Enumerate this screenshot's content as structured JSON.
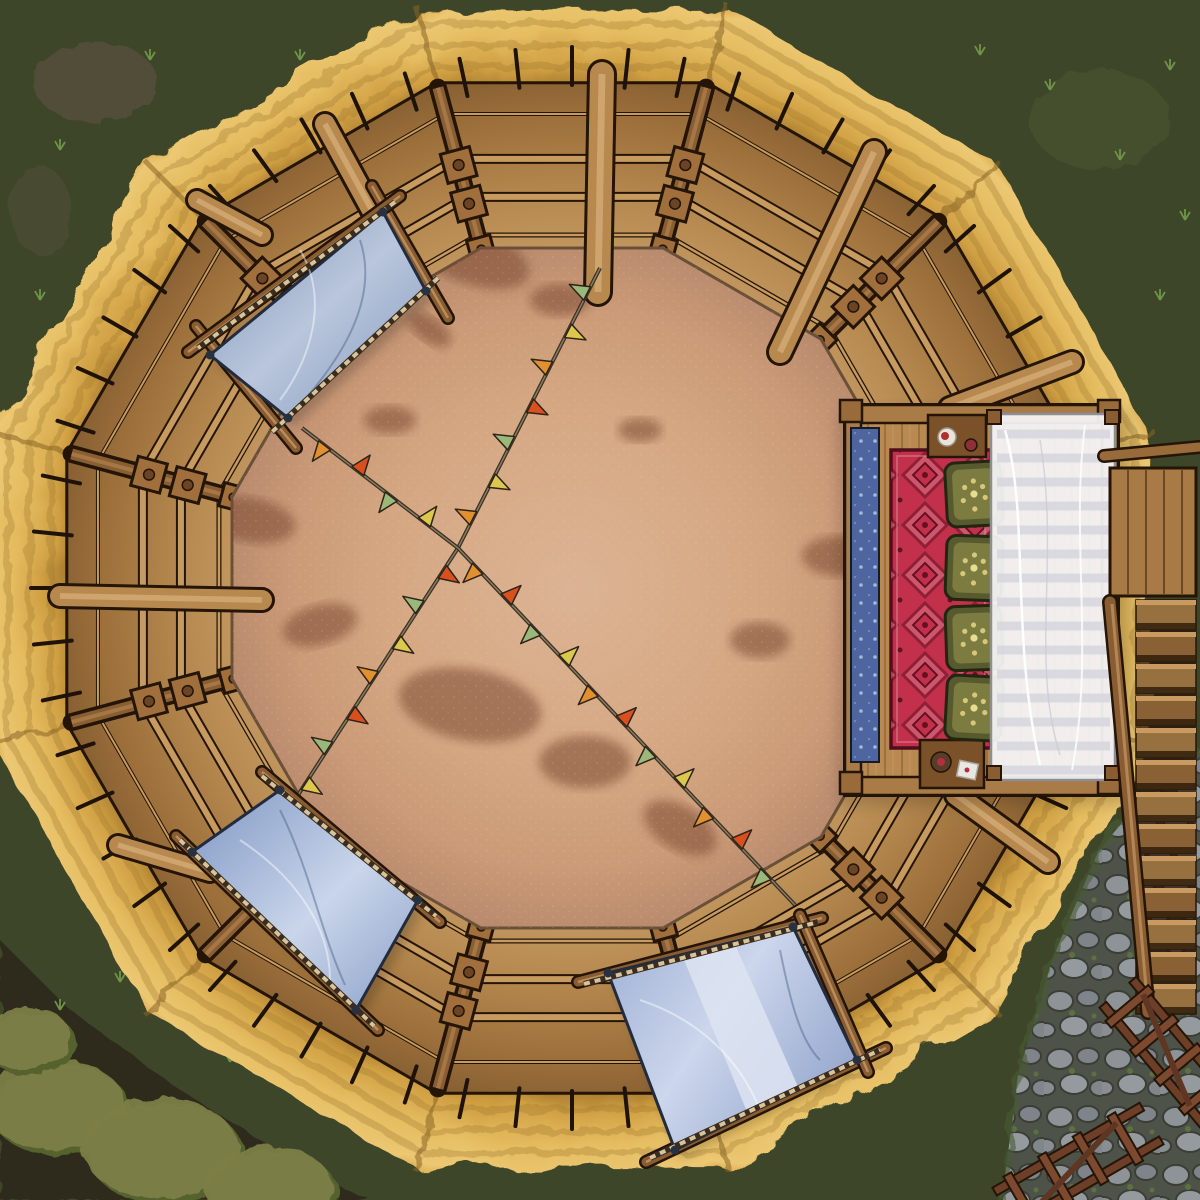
{
  "title": "Top-down circular arena battle map with thatched roof ring, palisade wall, VIP platform and canvas awnings",
  "palette": {
    "grass_dark": "#3d4629",
    "grass_plant": "#6f9448",
    "soil_dark": "#2f2a1e",
    "bush_olive": "#7d7f47",
    "bush_shadow": "#55622f",
    "dirt_patch": "#5c5140",
    "cobble_bg": "#4e5349",
    "cobble_stone": "#8d9397",
    "moss_green": "#5d7040",
    "thatch_base": "#c89a45",
    "thatch_gold": "#ddab52",
    "thatch_light": "#ecc873",
    "thatch_shadow": "#9c742f",
    "seam_brown": "#8a6528",
    "wood_light": "#c79a5f",
    "wood_mid": "#a87b46",
    "wood_beam": "#b8894f",
    "wood_dark": "#6b4423",
    "outline": "#241507",
    "floor_sand": "#d3a27f",
    "floor_sand_light": "#dcb394",
    "floor_patch": "#7c4a33",
    "canvas_blue": "#8398bc",
    "canvas_blue_light": "#c9d5ea",
    "canvas_pale": "#dde4f2",
    "canopy_white": "#f4f4f6",
    "canopy_stripe": "#d5d5dc",
    "carpet_red": "#c2304b",
    "carpet_pink": "#d8778a",
    "carpet_maroon": "#5e1020",
    "runner_blue": "#4e66a0",
    "cushion_olive": "#565a2e",
    "cushion_inner": "#7c7c41",
    "cushion_gold": "#d6c878",
    "rope_tan": "#d7c49a",
    "rope_dark": "#3a2d1f",
    "flag_green": "#9bb87b",
    "flag_yellow": "#ddc84e",
    "flag_orange": "#e2902f",
    "flag_red": "#d9501f"
  },
  "objects": {
    "arena": "circular dirt fighting pit inside a 12-sided palisade",
    "roof": "golden thatch ring with 12 radial seams",
    "awnings": 3,
    "awning_color": "steel blue canvas",
    "bunting_lines": 2,
    "flag_colors": [
      "green",
      "yellow",
      "orange",
      "red"
    ],
    "vip_platform": "east side, red patterned carpet, blue runner, 4 olive cushions, 2 side tables, white striped canopy",
    "stairs": "wooden staircase descending on the east side to a cobblestone path",
    "fences": 2
  },
  "scene": {
    "center": [
      572,
      588
    ],
    "ring": {
      "sides": 12,
      "first_vertex_deg": 15,
      "thatch_r": 600,
      "thatch_backfill_r": 566,
      "texture_rings": [
        540,
        562,
        584
      ],
      "wall_outer_r": 523,
      "wall_inner_r": 344,
      "floor_r": 352
    },
    "wall": {
      "rails": [
        [
          0.18,
          4,
          2
        ],
        [
          0.44,
          10,
          6
        ],
        [
          0.66,
          10,
          6
        ],
        [
          0.88,
          5,
          2.5
        ]
      ],
      "blocks": [
        [
          0.44,
          30
        ],
        [
          0.66,
          30
        ],
        [
          0.92,
          24
        ]
      ],
      "post_outer_r": 518,
      "post_inner_r": 336,
      "spike_from_r": 503,
      "spike_to_r": 541,
      "spike_offsets": [
        -12,
        -6,
        0,
        6,
        12
      ],
      "skip_spike_side": 0
    },
    "floor_patches": [
      [
        470,
        255,
        62,
        28,
        20
      ],
      [
        560,
        300,
        30,
        16,
        0
      ],
      [
        250,
        520,
        46,
        22,
        10
      ],
      [
        320,
        625,
        38,
        20,
        -15
      ],
      [
        470,
        705,
        72,
        36,
        10
      ],
      [
        585,
        762,
        46,
        26,
        0
      ],
      [
        680,
        828,
        40,
        22,
        30
      ],
      [
        760,
        640,
        30,
        18,
        0
      ],
      [
        838,
        556,
        36,
        20,
        0
      ],
      [
        640,
        430,
        22,
        12,
        0
      ],
      [
        390,
        420,
        26,
        14,
        0
      ],
      [
        718,
        938,
        40,
        20,
        -20
      ],
      [
        430,
        330,
        24,
        12,
        35
      ]
    ],
    "beams": [
      [
        602,
        74,
        598,
        292,
        24
      ],
      [
        874,
        152,
        780,
        352,
        22
      ],
      [
        950,
        408,
        1072,
        362,
        20
      ],
      [
        60,
        596,
        262,
        600,
        20
      ],
      [
        197,
        200,
        262,
        235,
        18
      ],
      [
        325,
        124,
        374,
        214,
        20
      ],
      [
        118,
        845,
        210,
        872,
        18
      ],
      [
        956,
        795,
        1048,
        862,
        20
      ]
    ],
    "bunting": {
      "lines": [
        [
          [
            600,
            268
          ],
          [
            458,
            548
          ],
          [
            298,
            795
          ]
        ],
        [
          [
            302,
            428
          ],
          [
            458,
            548
          ],
          [
            795,
            905
          ]
        ]
      ],
      "spacing": 42,
      "flag_len": 15,
      "flag_h": 20
    },
    "awnings": [
      {
        "id": "awning-nw",
        "quad": [
          [
            383,
            212
          ],
          [
            426,
            291
          ],
          [
            288,
            418
          ],
          [
            210,
            355
          ]
        ],
        "poles": [
          [
            372,
            186,
            448,
            318
          ],
          [
            196,
            326,
            296,
            448
          ],
          [
            400,
            196,
            188,
            352
          ]
        ],
        "ropes": [
          [
            438,
            278,
            272,
            432
          ],
          [
            395,
            202,
            198,
            348
          ]
        ],
        "folds": [
          "M300,250 C330,300 310,360 280,400",
          "M360,240 C380,300 340,360 300,405"
        ]
      },
      {
        "id": "awning-sw",
        "quad": [
          [
            280,
            790
          ],
          [
            418,
            900
          ],
          [
            356,
            1010
          ],
          [
            192,
            852
          ]
        ],
        "poles": [
          [
            262,
            772,
            440,
            922
          ],
          [
            176,
            836,
            378,
            1030
          ]
        ],
        "ropes": [
          [
            262,
            776,
            436,
            916
          ],
          [
            180,
            840,
            374,
            1026
          ]
        ],
        "folds": [
          "M240,840 C300,880 330,930 330,980",
          "M280,810 C310,870 320,930 345,985"
        ]
      },
      {
        "id": "awning-s",
        "quad": [
          [
            793,
            927
          ],
          [
            857,
            1060
          ],
          [
            675,
            1150
          ],
          [
            608,
            973
          ]
        ],
        "poles": [
          [
            578,
            982,
            822,
            918
          ],
          [
            646,
            1162,
            886,
            1048
          ],
          [
            800,
            915,
            868,
            1072
          ]
        ],
        "ropes": [
          [
            584,
            984,
            818,
            922
          ],
          [
            650,
            1158,
            880,
            1050
          ]
        ],
        "stripe": [
          [
            682,
            955
          ],
          [
            734,
            942
          ],
          [
            799,
            1089
          ],
          [
            748,
            1114
          ]
        ],
        "folds": [
          "M640,1000 C700,1020 740,1060 760,1110",
          "M780,950 C790,1000 800,1040 820,1060"
        ]
      }
    ],
    "platform": {
      "cushion_x": 946,
      "cushion_w": 56,
      "cushion_ys": [
        462,
        536,
        606,
        676
      ],
      "cushion_h": 64,
      "cushion_rot": [
        -3,
        2,
        -2,
        3
      ],
      "floral_offsets": [
        [
          0,
          -13
        ],
        [
          11,
          4
        ],
        [
          -11,
          6
        ],
        [
          0,
          15
        ],
        [
          -9,
          -7
        ],
        [
          9,
          -7
        ]
      ],
      "canopy_stripe_y0": 434,
      "canopy_stripe_y1": 770,
      "canopy_stripe_step": 24,
      "canopy_x0": 997,
      "canopy_x1": 1110
    },
    "stairs": {
      "tread_x": 1136,
      "tread_w": 60,
      "tread_y0": 600,
      "tread_step": 32,
      "tread_count": 13
    },
    "bushes": [
      [
        55,
        1105,
        70,
        46
      ],
      [
        160,
        1148,
        78,
        50
      ],
      [
        268,
        1186,
        64,
        40
      ],
      [
        25,
        1038,
        46,
        32
      ]
    ],
    "plants": [
      [
        60,
        150
      ],
      [
        150,
        60
      ],
      [
        230,
        140
      ],
      [
        40,
        300
      ],
      [
        92,
        390
      ],
      [
        300,
        60
      ],
      [
        1050,
        90
      ],
      [
        1120,
        160
      ],
      [
        1170,
        70
      ],
      [
        980,
        55
      ],
      [
        1160,
        300
      ],
      [
        1185,
        220
      ],
      [
        60,
        1010
      ],
      [
        230,
        1062
      ],
      [
        120,
        982
      ],
      [
        1120,
        700
      ]
    ]
  }
}
